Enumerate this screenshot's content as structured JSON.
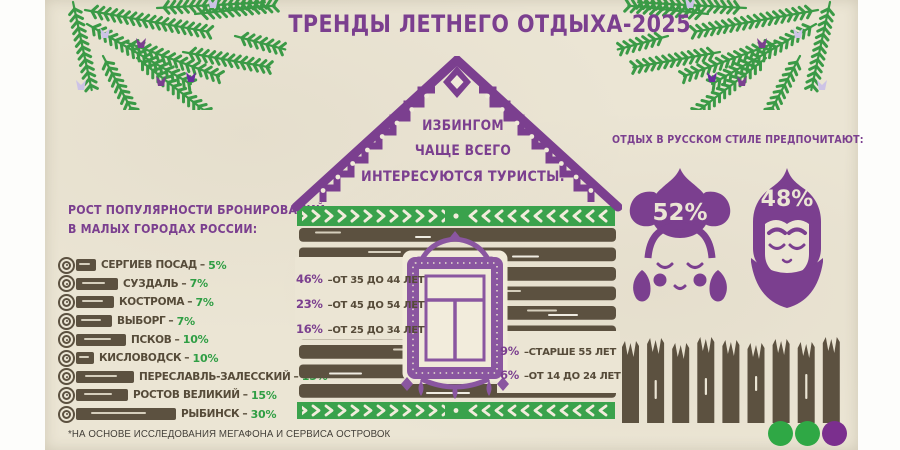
{
  "title": "ТРЕНДЫ ЛЕТНЕГО ОТДЫХА-2025",
  "dash": "–",
  "left_section": {
    "heading_line1": "РОСТ ПОПУЛЯРНОСТИ БРОНИРОВАНИЙ",
    "heading_line2": "В МАЛЫХ ГОРОДАХ РОССИИ:",
    "cities": [
      {
        "name": "СЕРГИЕВ ПОСАД",
        "value": "5%"
      },
      {
        "name": "СУЗДАЛЬ",
        "value": "7%"
      },
      {
        "name": "КОСТРОМА",
        "value": "7%"
      },
      {
        "name": "ВЫБОРГ",
        "value": "7%"
      },
      {
        "name": "ПСКОВ",
        "value": "10%"
      },
      {
        "name": "КИСЛОВОДСК",
        "value": "10%"
      },
      {
        "name": "ПЕРЕСЛАВЛЬ-ЗАЛЕССКИЙ",
        "value": "15%"
      },
      {
        "name": "РОСТОВ ВЕЛИКИЙ",
        "value": "15%"
      },
      {
        "name": "РЫБИНСК",
        "value": "30%"
      }
    ]
  },
  "house": {
    "roof_line1": "ИЗБИНГОМ",
    "roof_line2": "ЧАЩЕ ВСЕГО",
    "roof_line3": "ИНТЕРЕСУЮТСЯ ТУРИСТЫ:",
    "age_groups_left": [
      {
        "pct": "46%",
        "label": "–ОТ 35 ДО 44 ЛЕТ"
      },
      {
        "pct": "23%",
        "label": "–ОТ 45 ДО 54 ЛЕТ"
      },
      {
        "pct": "16%",
        "label": "–ОТ 25 ДО 34 ЛЕТ"
      }
    ],
    "age_groups_right": [
      {
        "pct": "9%",
        "label": "–СТАРШЕ 55 ЛЕТ"
      },
      {
        "pct": "6%",
        "label": "–ОТ 14 ДО 24 ЛЕТ"
      }
    ]
  },
  "right_section": {
    "heading": "ОТДЫХ В РУССКОМ СТИЛЕ ПРЕДПОЧИТАЮТ:",
    "woman_pct": "52%",
    "man_pct": "48%"
  },
  "footnote": "*НА ОСНОВЕ ИССЛЕДОВАНИЯ МЕГАФОНА И СЕРВИСА ОСТРОВОК",
  "colors": {
    "purple": "#7b3f8f",
    "green": "#2f9e44",
    "brown": "#5c5140",
    "paper": "#ebe5d4"
  },
  "chart_data": [
    {
      "type": "bar",
      "title": "РОСТ ПОПУЛЯРНОСТИ БРОНИРОВАНИЙ В МАЛЫХ ГОРОДАХ РОССИИ",
      "categories": [
        "СЕРГИЕВ ПОСАД",
        "СУЗДАЛЬ",
        "КОСТРОМА",
        "ВЫБОРГ",
        "ПСКОВ",
        "КИСЛОВОДСК",
        "ПЕРЕСЛАВЛЬ-ЗАЛЕССКИЙ",
        "РОСТОВ ВЕЛИКИЙ",
        "РЫБИНСК"
      ],
      "values": [
        5,
        7,
        7,
        7,
        10,
        10,
        15,
        15,
        30
      ],
      "unit": "%"
    },
    {
      "type": "bar",
      "title": "ИЗБИНГОМ ЧАЩЕ ВСЕГО ИНТЕРЕСУЮТСЯ ТУРИСТЫ",
      "categories": [
        "ОТ 35 ДО 44 ЛЕТ",
        "ОТ 45 ДО 54 ЛЕТ",
        "ОТ 25 ДО 34 ЛЕТ",
        "СТАРШЕ 55 ЛЕТ",
        "ОТ 14 ДО 24 ЛЕТ"
      ],
      "values": [
        46,
        23,
        16,
        9,
        6
      ],
      "unit": "%"
    },
    {
      "type": "pie",
      "title": "ОТДЫХ В РУССКОМ СТИЛЕ ПРЕДПОЧИТАЮТ",
      "categories": [
        "woman-figure",
        "man-figure"
      ],
      "values": [
        52,
        48
      ],
      "unit": "%"
    }
  ]
}
